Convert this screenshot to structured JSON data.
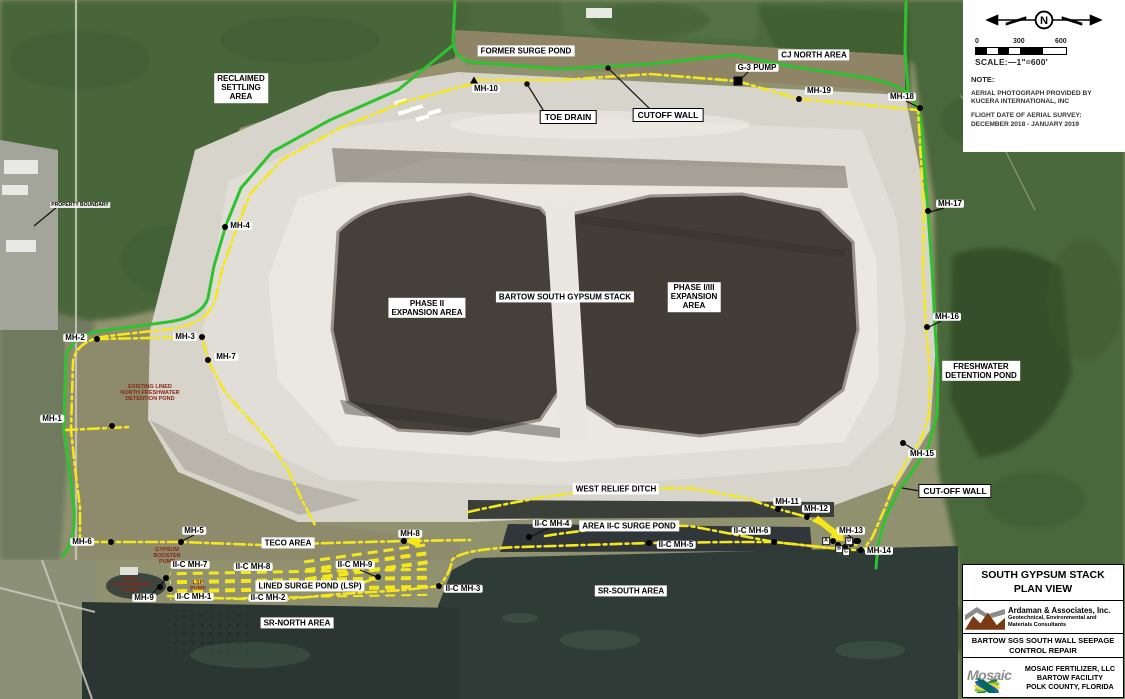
{
  "colors": {
    "line_green": "#2ec32e",
    "line_yellow": "#f5e71b",
    "label_red": "#8a2616",
    "water_dark": "#2e3a34",
    "pond_brown": "#45403a",
    "stack_light": "#d7d4cc",
    "forest_green": "#4d6b3c"
  },
  "legend": {
    "compass_label": "N",
    "scale_ticks": [
      "0",
      "300",
      "600"
    ],
    "scale_text": "SCALE:—1\"=600'",
    "note_heading": "NOTE:",
    "note1": "AERIAL PHOTOGRAPH PROVIDED BY\nKUCERA INTERNATIONAL, INC",
    "note2": "FLIGHT DATE OF AERIAL SURVEY:\nDECEMBER 2018 - JANUARY 2019"
  },
  "title_block": {
    "title": "SOUTH GYPSUM STACK\nPLAN VIEW",
    "consultant_name": "Ardaman & Associates, Inc.",
    "consultant_tagline": "Geotechnical, Environmental and\nMaterials Consultants",
    "project": "BARTOW SGS SOUTH WALL SEEPAGE\nCONTROL REPAIR",
    "client": "MOSAIC FERTILIZER, LLC\nBARTOW FACILITY\nPOLK COUNTY, FLORIDA",
    "mosaic_wordmark": "Mosaic"
  },
  "map": {
    "labels": [
      {
        "name": "reclaimed-settling-area",
        "cls": "area",
        "text": "RECLAIMED\nSETTLING\nAREA",
        "x": 241,
        "y": 88
      },
      {
        "name": "former-surge-pond",
        "cls": "area",
        "text": "FORMER SURGE POND",
        "x": 526,
        "y": 51
      },
      {
        "name": "cj-north-area",
        "cls": "area",
        "text": "CJ NORTH AREA",
        "x": 814,
        "y": 55
      },
      {
        "name": "g3-pump",
        "cls": "mh",
        "text": "G-3 PUMP",
        "x": 757,
        "y": 68,
        "marker": "square",
        "mx": 738,
        "my": 81
      },
      {
        "name": "mh-10",
        "cls": "mh",
        "text": "MH-10",
        "x": 486,
        "y": 89,
        "marker": "triangle",
        "mx": 474,
        "my": 80
      },
      {
        "name": "mh-19",
        "cls": "mh",
        "text": "MH-19",
        "x": 819,
        "y": 91,
        "marker": "dot",
        "mx": 799,
        "my": 99
      },
      {
        "name": "mh-18",
        "cls": "mh",
        "text": "MH-18",
        "x": 902,
        "y": 97,
        "marker": "dot",
        "mx": 920,
        "my": 108
      },
      {
        "name": "toe-drain",
        "cls": "bordered",
        "text": "TOE DRAIN",
        "x": 568,
        "y": 117
      },
      {
        "name": "cutoff-wall",
        "cls": "bordered",
        "text": "CUTOFF WALL",
        "x": 668,
        "y": 115
      },
      {
        "name": "mh-4",
        "cls": "mh",
        "text": "MH-4",
        "x": 240,
        "y": 226,
        "marker": "dot",
        "mx": 225,
        "my": 227
      },
      {
        "name": "mh-17",
        "cls": "mh",
        "text": "MH-17",
        "x": 950,
        "y": 204,
        "marker": "dot",
        "mx": 928,
        "my": 211
      },
      {
        "name": "phase-ii-expansion-area",
        "cls": "area",
        "text": "PHASE II\nEXPANSION AREA",
        "x": 427,
        "y": 308
      },
      {
        "name": "bartow-south-gypsum-stack",
        "cls": "area",
        "text": "BARTOW SOUTH GYPSUM STACK",
        "x": 565,
        "y": 297
      },
      {
        "name": "phase-i-iii-expansion-area",
        "cls": "area",
        "text": "PHASE I/III\nEXPANSION\nAREA",
        "x": 694,
        "y": 297
      },
      {
        "name": "mh-16",
        "cls": "mh",
        "text": "MH-16",
        "x": 947,
        "y": 317,
        "marker": "dot",
        "mx": 927,
        "my": 327
      },
      {
        "name": "freshwater-detention-pond",
        "cls": "area",
        "text": "FRESHWATER\nDETENTION POND",
        "x": 981,
        "y": 371
      },
      {
        "name": "mh-2",
        "cls": "mh",
        "text": "MH-2",
        "x": 75,
        "y": 338,
        "marker": "dot",
        "mx": 97,
        "my": 339
      },
      {
        "name": "mh-3",
        "cls": "mh",
        "text": "MH-3",
        "x": 185,
        "y": 337,
        "marker": "dot",
        "mx": 202,
        "my": 337
      },
      {
        "name": "mh-7",
        "cls": "mh",
        "text": "MH-7",
        "x": 226,
        "y": 357,
        "marker": "dot",
        "mx": 208,
        "my": 360
      },
      {
        "name": "existing-lined-north-freshwater-detention-pond",
        "cls": "red",
        "text": "EXISTING LINED\nNORTH FRESHWATER\nDETENTION POND",
        "x": 150,
        "y": 393
      },
      {
        "name": "property-boundary",
        "cls": "tiny",
        "text": "PROPERTY BOUNDARY",
        "x": 80,
        "y": 205
      },
      {
        "name": "mh-1",
        "cls": "mh",
        "text": "MH-1",
        "x": 52,
        "y": 419,
        "marker": "dot",
        "mx": 112,
        "my": 426
      },
      {
        "name": "mh-15",
        "cls": "mh",
        "text": "MH-15",
        "x": 922,
        "y": 454,
        "marker": "dot",
        "mx": 903,
        "my": 443
      },
      {
        "name": "cut-off-wall",
        "cls": "bordered",
        "text": "CUT-OFF WALL",
        "x": 955,
        "y": 491
      },
      {
        "name": "west-relief-ditch",
        "cls": "area",
        "text": "WEST RELIEF DITCH",
        "x": 616,
        "y": 489
      },
      {
        "name": "mh-11",
        "cls": "mh",
        "text": "MH-11",
        "x": 787,
        "y": 502,
        "marker": "dot",
        "mx": 778,
        "my": 509
      },
      {
        "name": "mh-12",
        "cls": "mh",
        "text": "MH-12",
        "x": 816,
        "y": 509,
        "marker": "dot",
        "mx": 807,
        "my": 517
      },
      {
        "name": "mh-5",
        "cls": "mh",
        "text": "MH-5",
        "x": 194,
        "y": 531,
        "marker": "dot",
        "mx": 181,
        "my": 542
      },
      {
        "name": "teco-area",
        "cls": "area",
        "text": "TECO AREA",
        "x": 288,
        "y": 543
      },
      {
        "name": "mh-8",
        "cls": "mh",
        "text": "MH-8",
        "x": 410,
        "y": 534,
        "marker": "dot",
        "mx": 404,
        "my": 541
      },
      {
        "name": "area-ii-c-surge-pond",
        "cls": "area",
        "text": "AREA II-C SURGE POND",
        "x": 629,
        "y": 526
      },
      {
        "name": "ii-c-mh-4",
        "cls": "mh",
        "text": "II-C MH-4",
        "x": 552,
        "y": 524,
        "marker": "dot",
        "mx": 529,
        "my": 537
      },
      {
        "name": "ii-c-mh-6",
        "cls": "mh",
        "text": "II-C MH-6",
        "x": 751,
        "y": 531,
        "marker": "dot",
        "mx": 774,
        "my": 542
      },
      {
        "name": "ii-c-mh-5",
        "cls": "mh",
        "text": "II-C MH-5",
        "x": 676,
        "y": 545,
        "marker": "dot",
        "mx": 649,
        "my": 543
      },
      {
        "name": "mh-13",
        "cls": "mh",
        "text": "MH-13",
        "x": 851,
        "y": 531,
        "marker": "dot",
        "mx": 856,
        "my": 541
      },
      {
        "name": "mh-14",
        "cls": "mh",
        "text": "MH-14",
        "x": 879,
        "y": 551,
        "marker": "dot",
        "mx": 861,
        "my": 550
      },
      {
        "name": "mh-6",
        "cls": "mh",
        "text": "MH-6",
        "x": 82,
        "y": 542,
        "marker": "dot",
        "mx": 111,
        "my": 542
      },
      {
        "name": "gypsum-booster-pump",
        "cls": "red",
        "text": "GYPSUM\nBOOSTER\nPUMP",
        "x": 167,
        "y": 556
      },
      {
        "name": "ii-c-mh-7",
        "cls": "mh",
        "text": "II-C MH-7",
        "x": 190,
        "y": 565
      },
      {
        "name": "ii-c-mh-8",
        "cls": "mh",
        "text": "II-C MH-8",
        "x": 253,
        "y": 567
      },
      {
        "name": "ii-c-mh-9",
        "cls": "mh",
        "text": "II-C MH-9",
        "x": 355,
        "y": 565,
        "marker": "dot",
        "mx": 378,
        "my": 577
      },
      {
        "name": "spill-containment-pond",
        "cls": "red",
        "text": "SPILL\nCONTAINMENT\nPOND",
        "x": 131,
        "y": 585
      },
      {
        "name": "lsp-pump",
        "cls": "red",
        "text": "LSP\nPUMP",
        "x": 198,
        "y": 586
      },
      {
        "name": "lined-surge-pond-lsp",
        "cls": "area",
        "text": "LINED SURGE POND (LSP)",
        "x": 310,
        "y": 586
      },
      {
        "name": "ii-c-mh-3",
        "cls": "mh",
        "text": "II-C MH-3",
        "x": 463,
        "y": 589,
        "marker": "dot",
        "mx": 439,
        "my": 586
      },
      {
        "name": "mh-9",
        "cls": "mh",
        "text": "MH-9",
        "x": 144,
        "y": 598,
        "marker": "dot",
        "mx": 166,
        "my": 578
      },
      {
        "name": "ii-c-mh-1",
        "cls": "mh",
        "text": "II-C MH-1",
        "x": 194,
        "y": 597
      },
      {
        "name": "ii-c-mh-2",
        "cls": "mh",
        "text": "II-C MH-2",
        "x": 268,
        "y": 598
      },
      {
        "name": "sr-south-area",
        "cls": "area",
        "text": "SR-SOUTH AREA",
        "x": 631,
        "y": 591
      },
      {
        "name": "sr-north-area",
        "cls": "area",
        "text": "SR-NORTH AREA",
        "x": 297,
        "y": 623
      },
      {
        "name": "marker-a",
        "cls": "letter",
        "text": "A",
        "x": 826,
        "y": 541
      },
      {
        "name": "marker-b",
        "cls": "letter",
        "text": "B",
        "x": 839,
        "y": 549
      },
      {
        "name": "marker-c",
        "cls": "letter",
        "text": "C",
        "x": 846,
        "y": 552
      },
      {
        "name": "marker-d",
        "cls": "letter",
        "text": "D",
        "x": 849,
        "y": 541
      }
    ],
    "extra_dots": [
      [
        160,
        587
      ],
      [
        170,
        589
      ],
      [
        838,
        545
      ],
      [
        845,
        547
      ],
      [
        851,
        544
      ],
      [
        833,
        541
      ],
      [
        858,
        541
      ]
    ]
  }
}
